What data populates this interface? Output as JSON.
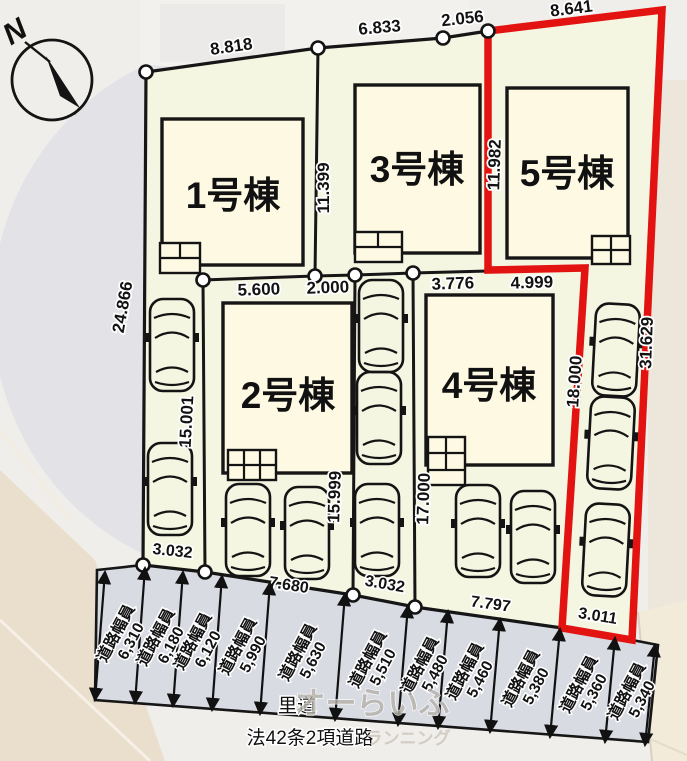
{
  "plan": {
    "compass_label": "N",
    "buildings": [
      {
        "name": "1号棟"
      },
      {
        "name": "2号棟"
      },
      {
        "name": "3号棟"
      },
      {
        "name": "4号棟"
      },
      {
        "name": "5号棟"
      }
    ],
    "dims": {
      "top": [
        "8.818",
        "6.833",
        "2.056",
        "8.641"
      ],
      "left_edge": "24.866",
      "lot1_divider": "11.399",
      "lot5_left": "11.982",
      "lot5_right": "31.629",
      "lot5_strip_left": "18.000",
      "lot2_left": "15.001",
      "lot2_right": "15.999",
      "lot4_left": "17.000",
      "lot2_top": [
        "5.600",
        "2.000"
      ],
      "lot4_top": [
        "3.776",
        "4.999"
      ],
      "bottom": [
        "3.032",
        "7.680",
        "3.032",
        "7.797",
        "3.011"
      ]
    },
    "road": {
      "label": "道路幅員",
      "widths": [
        "6,310",
        "6,180",
        "6,120",
        "5,990",
        "5,630",
        "5,510",
        "5,480",
        "5,460",
        "5,380",
        "5,360",
        "5,340"
      ],
      "name": "里道",
      "legal": "法42条2項道路"
    },
    "watermark": [
      "オーらいふ",
      "ランニング"
    ],
    "colors": {
      "lot_fill": "#f4f6e2",
      "building_fill": "#fdf9e3",
      "road_fill": "#d9dbe3",
      "highlight_red": "#e21310",
      "line_black": "#161616"
    }
  }
}
